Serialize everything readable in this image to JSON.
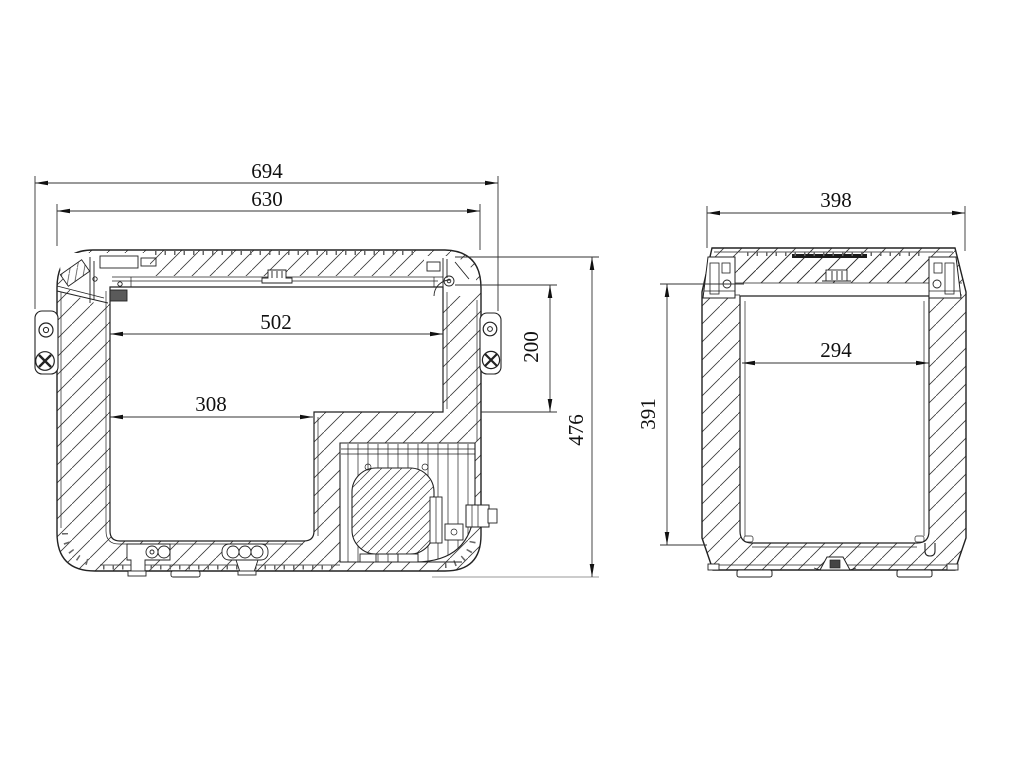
{
  "title": "cooler-cross-section-technical-drawing",
  "colors": {
    "background": "#ffffff",
    "line": "#222222",
    "dimension": "#333333",
    "text": "#111111"
  },
  "side_view": {
    "name": "side cross-section",
    "dims": {
      "overall_width": "694",
      "lid_width": "630",
      "inner_width_top": "502",
      "inner_width_bottom": "308",
      "step_depth": "200",
      "overall_height": "476"
    }
  },
  "end_view": {
    "name": "end cross-section",
    "dims": {
      "overall_width": "398",
      "inner_width": "294",
      "inner_height": "391"
    }
  }
}
